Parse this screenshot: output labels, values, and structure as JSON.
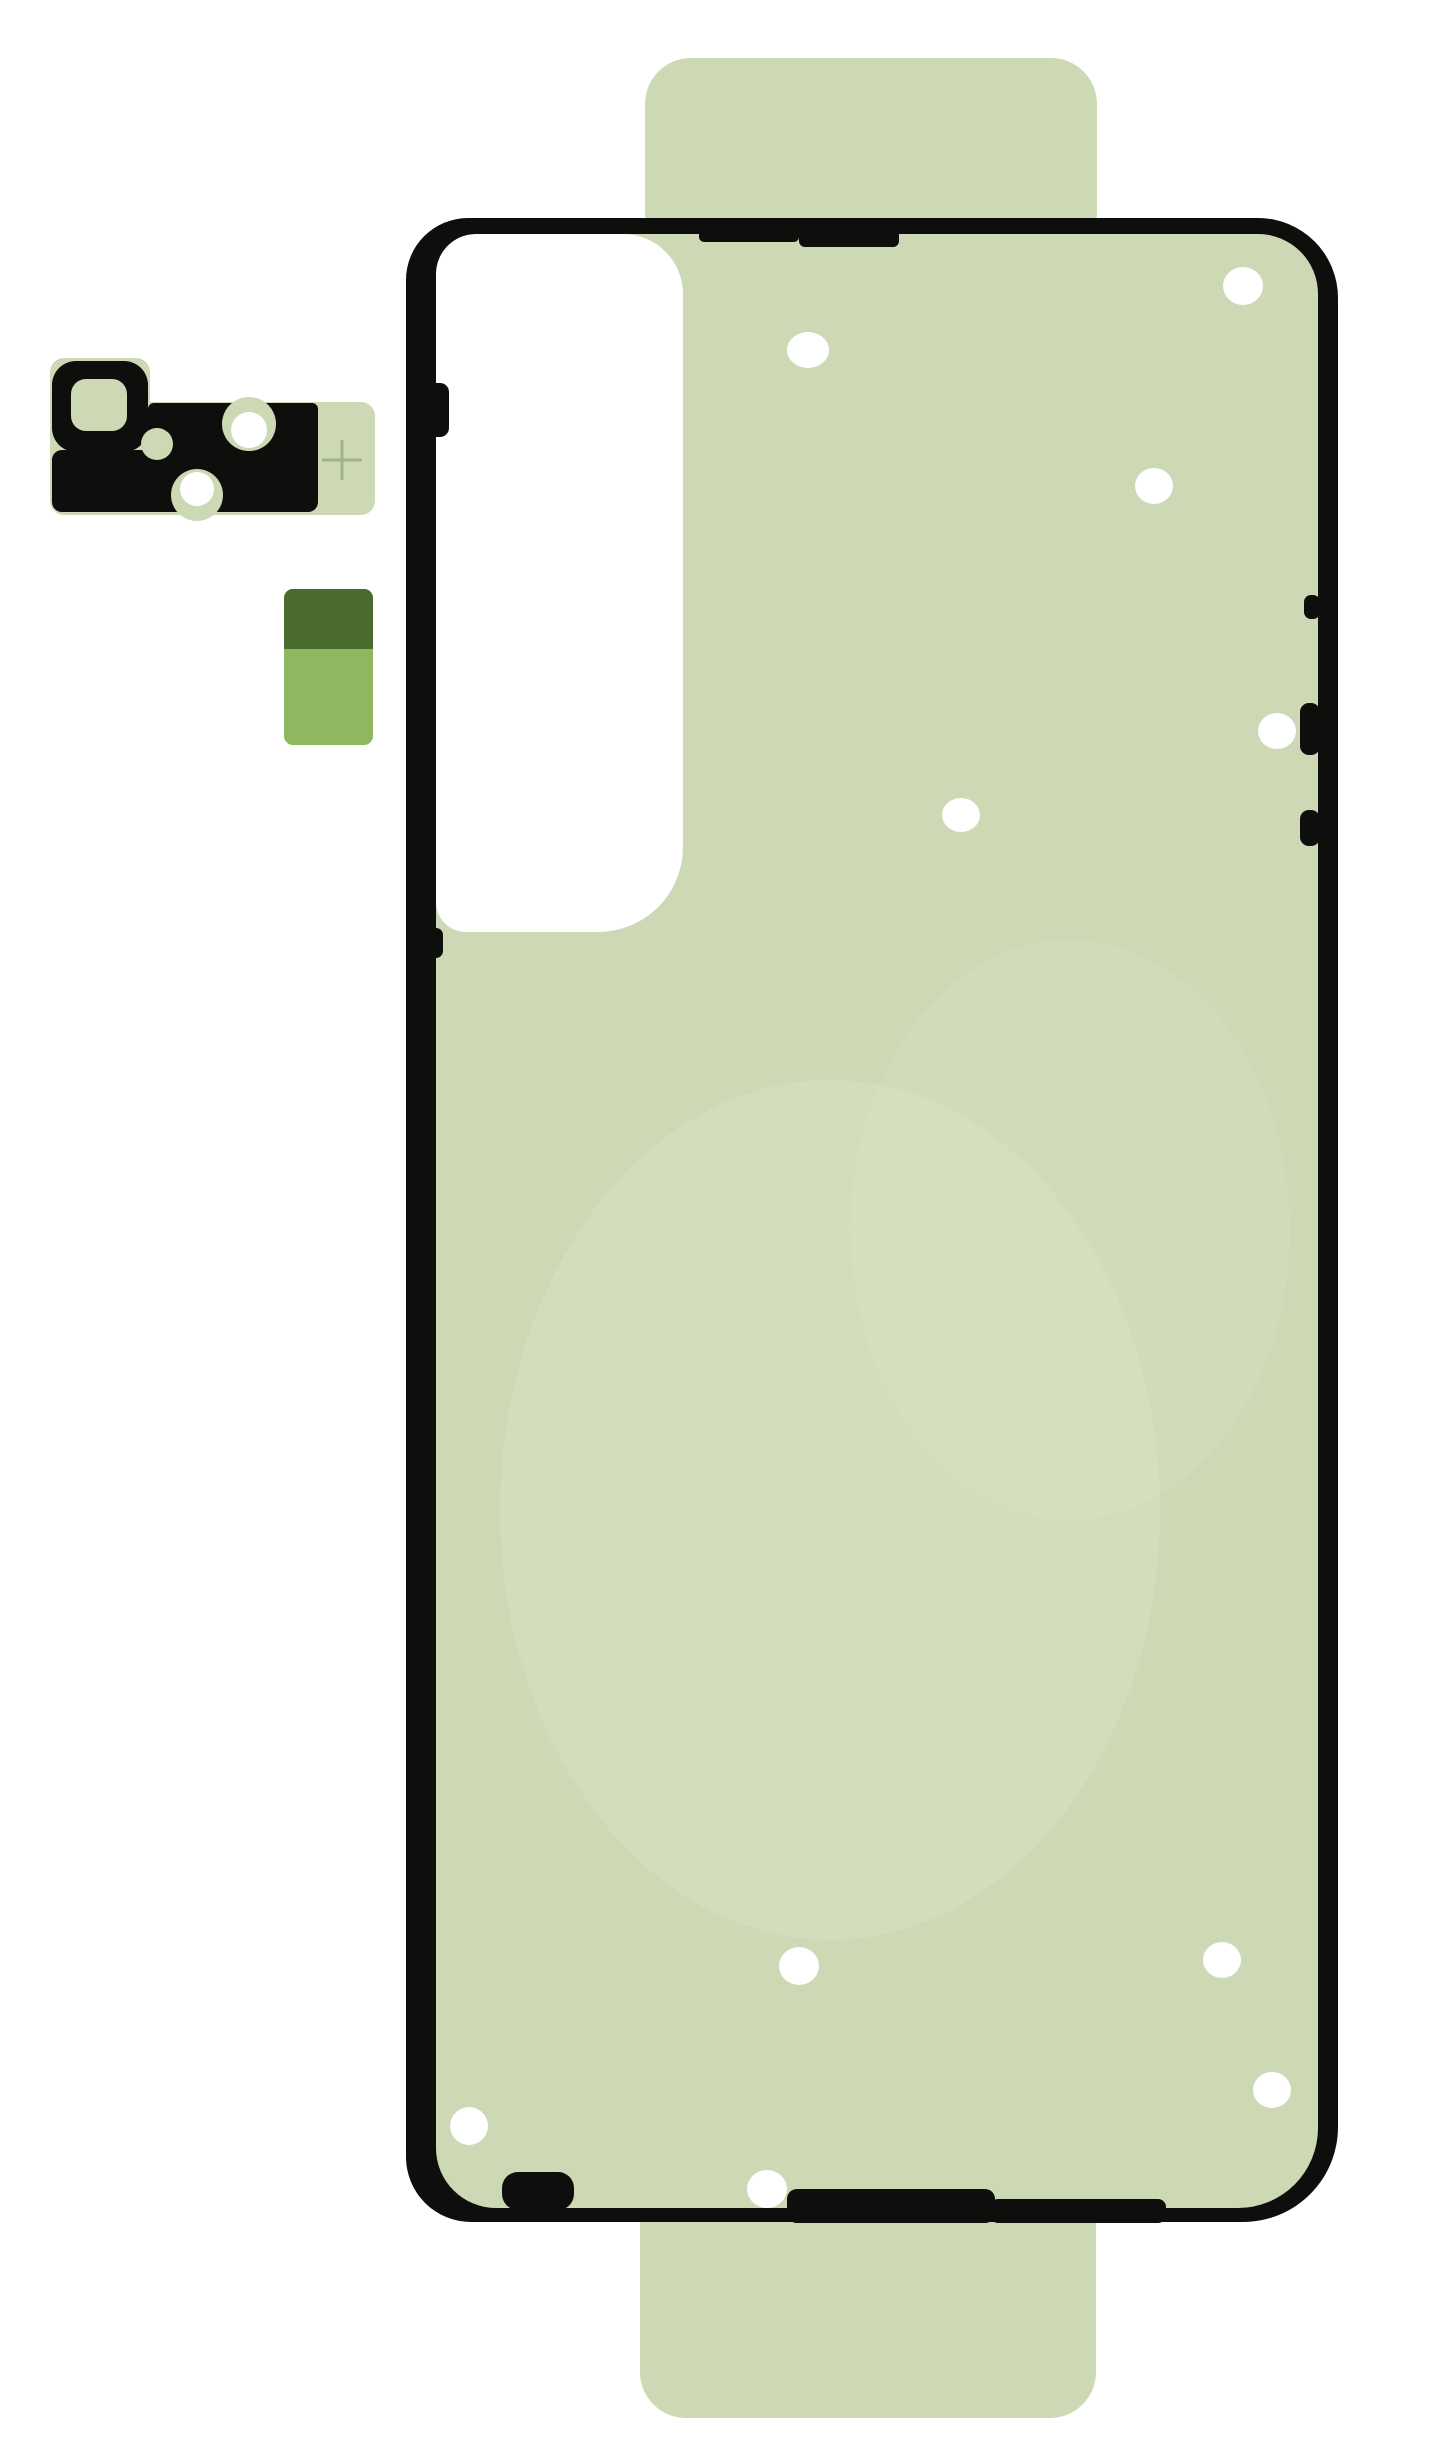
{
  "scene": {
    "kind": "product-photo",
    "subject": "phone-back-cover-adhesive-kit",
    "colors": {
      "background": "#ffffff",
      "adhesive_green": "#ccd9b4",
      "watermark_green": "#d9e3c6",
      "outline_black": "#0e0f0c",
      "cutout_white": "#ffffff",
      "hole_white": "#ffffff",
      "two_tone_top": "#4a6a2e",
      "two_tone_bottom": "#8fb75f",
      "plus_marker": "#a3b28d"
    },
    "top_tab": {
      "x": 645,
      "y": 58,
      "w": 452,
      "h": 200,
      "r": 46
    },
    "bottom_tab": {
      "x": 640,
      "y": 2150,
      "w": 456,
      "h": 268,
      "r": 46
    },
    "main_sheet": {
      "outer": {
        "x": 406,
        "y": 218,
        "w": 932,
        "h": 2004
      },
      "outer_radii": {
        "tl": 62,
        "tr": 80,
        "br": 95,
        "bl": 65
      },
      "inner": {
        "x": 436,
        "y": 234,
        "w": 882,
        "h": 1974
      },
      "inner_radii": {
        "tl": 50,
        "tr": 60,
        "br": 80,
        "bl": 60
      },
      "camera_cutout": {
        "x": 436,
        "y": 234,
        "w": 247,
        "h": 698,
        "radii": {
          "tl": 40,
          "tr": 60,
          "br": 85,
          "bl": 30
        }
      },
      "watermarks": [
        {
          "cx": 830,
          "cy": 1510,
          "rx": 330,
          "ry": 430,
          "opacity": 0.45
        },
        {
          "cx": 1070,
          "cy": 1230,
          "rx": 220,
          "ry": 290,
          "opacity": 0.3
        }
      ],
      "notches": [
        {
          "x": 425,
          "y": 383,
          "w": 24,
          "h": 54,
          "r": 9
        },
        {
          "x": 427,
          "y": 928,
          "w": 16,
          "h": 30,
          "r": 7
        },
        {
          "x": 699,
          "y": 228,
          "w": 100,
          "h": 14,
          "r": 5
        },
        {
          "x": 799,
          "y": 228,
          "w": 100,
          "h": 19,
          "r": 6
        },
        {
          "x": 1304,
          "y": 595,
          "w": 16,
          "h": 24,
          "r": 7
        },
        {
          "x": 1300,
          "y": 703,
          "w": 20,
          "h": 52,
          "r": 9
        },
        {
          "x": 1300,
          "y": 810,
          "w": 20,
          "h": 36,
          "r": 9
        },
        {
          "x": 787,
          "y": 2189,
          "w": 208,
          "h": 34,
          "r": 10
        },
        {
          "x": 990,
          "y": 2199,
          "w": 176,
          "h": 24,
          "r": 8
        },
        {
          "x": 502,
          "y": 2172,
          "w": 72,
          "h": 38,
          "r": 16
        }
      ],
      "holes": [
        {
          "x": 808,
          "y": 350,
          "rx": 21,
          "ry": 18
        },
        {
          "x": 1243,
          "y": 286,
          "rx": 20,
          "ry": 19
        },
        {
          "x": 1154,
          "y": 486,
          "rx": 19,
          "ry": 18
        },
        {
          "x": 961,
          "y": 815,
          "rx": 19,
          "ry": 17
        },
        {
          "x": 1277,
          "y": 731,
          "rx": 19,
          "ry": 18
        },
        {
          "x": 799,
          "y": 1966,
          "rx": 20,
          "ry": 19
        },
        {
          "x": 469,
          "y": 2126,
          "rx": 19,
          "ry": 19
        },
        {
          "x": 767,
          "y": 2189,
          "rx": 20,
          "ry": 19
        },
        {
          "x": 1222,
          "y": 1960,
          "rx": 19,
          "ry": 18
        },
        {
          "x": 1272,
          "y": 2090,
          "rx": 19,
          "ry": 18
        }
      ]
    },
    "camera_piece": {
      "base": [
        {
          "x": 50,
          "y": 358,
          "w": 100,
          "h": 157,
          "r": 14
        },
        {
          "x": 118,
          "y": 402,
          "w": 257,
          "h": 113,
          "r": 14
        }
      ],
      "ring": {
        "x": 52,
        "y": 361,
        "w": 96,
        "h": 91,
        "r": 24
      },
      "ring_hole": {
        "x": 71,
        "y": 379,
        "w": 56,
        "h": 52,
        "r": 15
      },
      "band": {
        "x": 52,
        "y": 450,
        "w": 266,
        "h": 62,
        "r": 10
      },
      "arm": {
        "x": 148,
        "y": 403,
        "w": 170,
        "h": 62,
        "r": 6
      },
      "bites": [
        {
          "x": 249,
          "y": 424,
          "r": 27
        },
        {
          "x": 197,
          "y": 495,
          "r": 26
        },
        {
          "x": 157,
          "y": 444,
          "r": 16
        }
      ],
      "holes": [
        {
          "x": 249,
          "y": 430,
          "r": 18
        },
        {
          "x": 197,
          "y": 489,
          "r": 17
        }
      ],
      "plus": {
        "icon": "plus-crosshair",
        "x": 342,
        "y": 460,
        "size": 40,
        "stroke_w": 3
      }
    },
    "two_tone_piece": {
      "x": 284,
      "y": 589,
      "w": 89,
      "h": 156,
      "r": 9,
      "split": 60
    }
  }
}
